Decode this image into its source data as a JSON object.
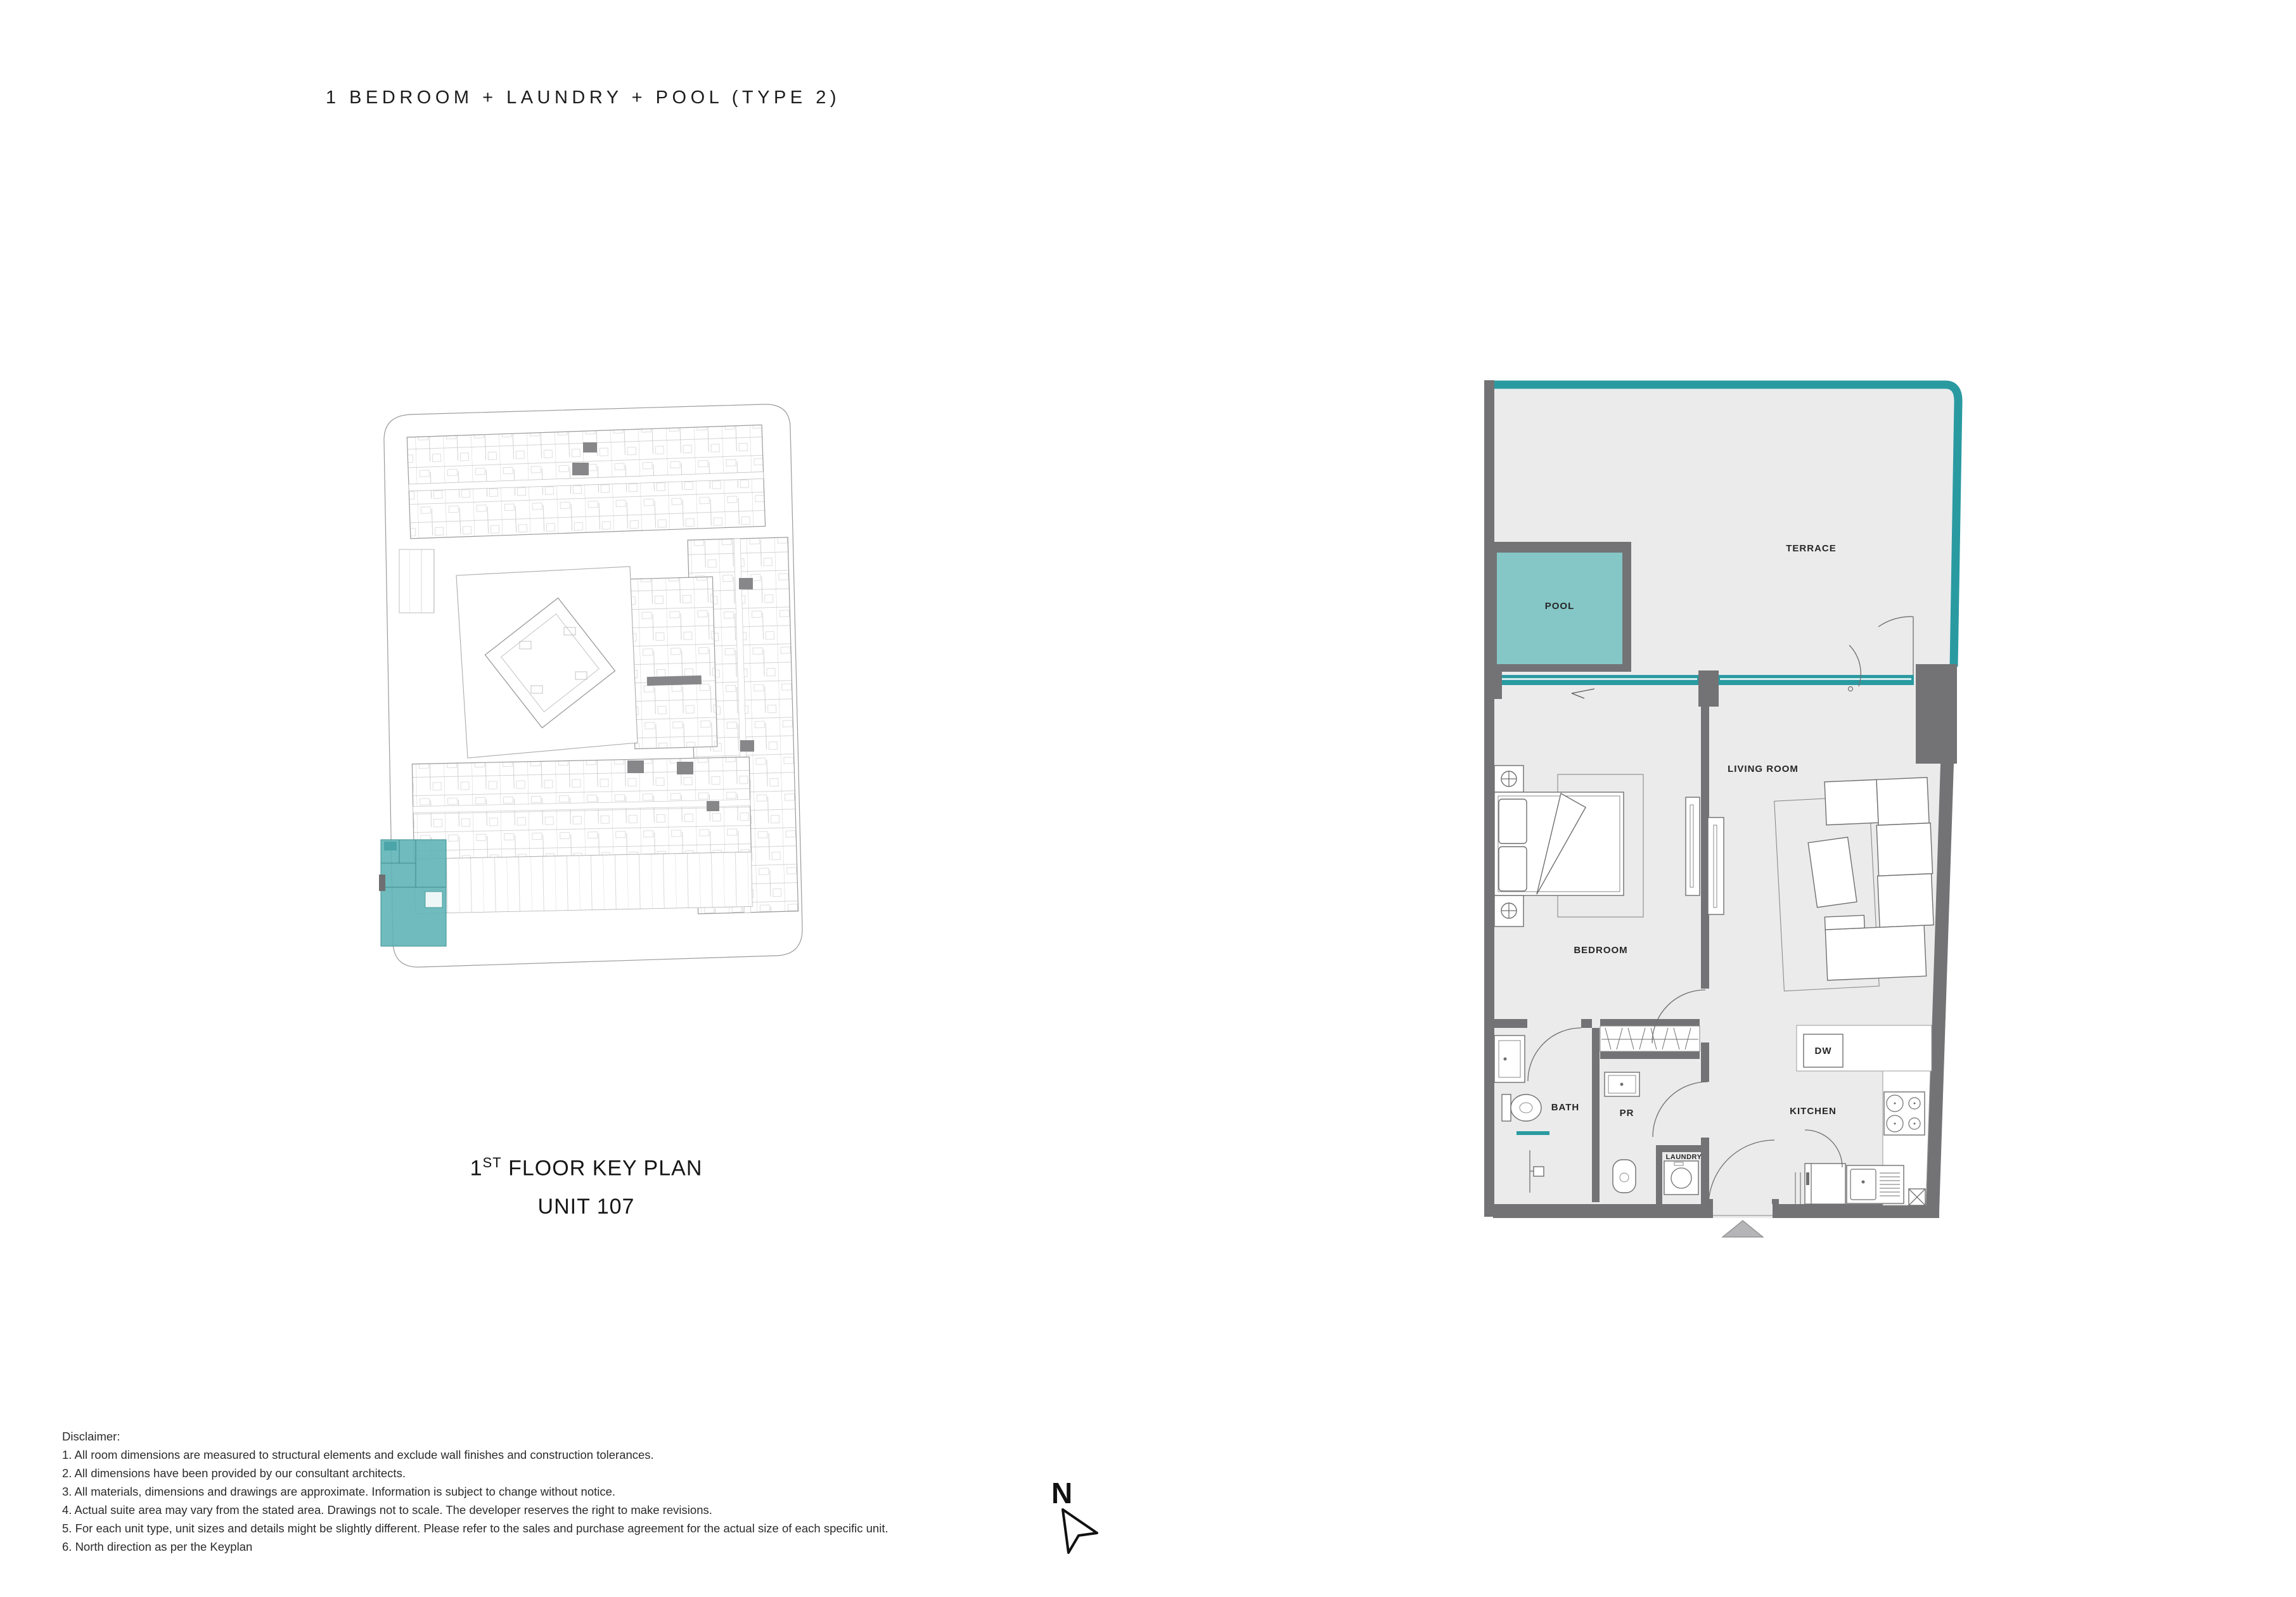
{
  "title": "1 BEDROOM + LAUNDRY + POOL (TYPE 2)",
  "caption": {
    "floor_number": "1",
    "floor_suffix": "ST",
    "floor_rest": " FLOOR KEY PLAN",
    "unit": "UNIT 107"
  },
  "north": {
    "label": "N"
  },
  "plan_labels": {
    "terrace": "TERRACE",
    "pool": "POOL",
    "living_room": "LIVING ROOM",
    "bedroom": "BEDROOM",
    "bath": "BATH",
    "pr": "PR",
    "laundry": "LAUNDRY",
    "kitchen": "KITCHEN",
    "dishwasher": "DW"
  },
  "disclaimer": {
    "heading": "Disclaimer:",
    "items": [
      "1. All room dimensions are measured to structural elements and exclude wall finishes and construction tolerances.",
      "2. All dimensions have been provided by our consultant architects.",
      "3. All materials, dimensions and drawings are approximate. Information is subject to change without notice.",
      "4. Actual suite area may vary from the stated area. Drawings not to scale. The developer reserves the right to make revisions.",
      "5. For each unit type, unit sizes and details might be slightly different. Please refer to the sales and purchase agreement for the actual size of each specific unit.",
      "6. North direction as per the Keyplan"
    ]
  },
  "colors": {
    "accent_teal": "#2a9aa1",
    "pool_fill": "#85c7c6",
    "wall_gray": "#737375",
    "floor_gray": "#ebebec",
    "highlight_teal": "#5fb4b6",
    "arrow_gray": "#b5b5b7"
  }
}
